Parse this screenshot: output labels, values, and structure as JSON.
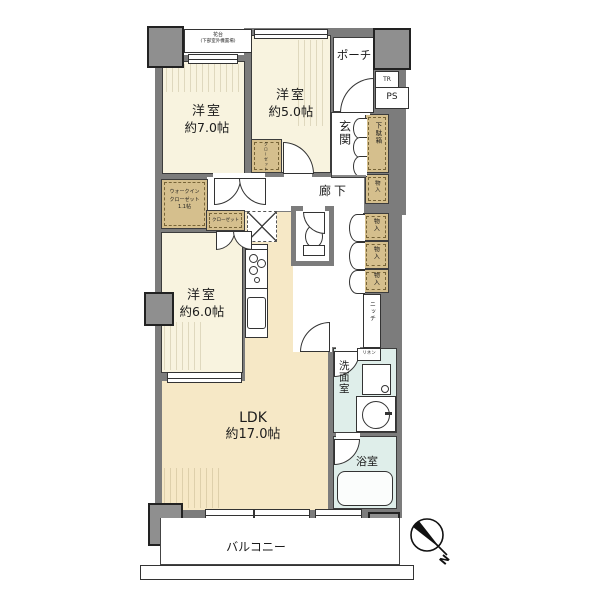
{
  "rooms": {
    "western7": {
      "name": "洋室",
      "size": "約7.0帖"
    },
    "western5": {
      "name": "洋室",
      "size": "約5.0帖"
    },
    "western6": {
      "name": "洋室",
      "size": "約6.0帖"
    },
    "ldk": {
      "name": "LDK",
      "size": "約17.0帖"
    },
    "porch": "ポーチ",
    "entrance": "玄関",
    "hallway": "廊下",
    "toilet": "トイレ",
    "washroom": "洗面室",
    "bathroom": "浴室",
    "balcony": "バルコニー",
    "niche": "ニッチ"
  },
  "storage": {
    "shoe_cabinet": "下駄箱",
    "closets": [
      "物入",
      "物入",
      "物入",
      "物入"
    ],
    "walk_in_closet": [
      "ウォークイン",
      "クローゼット",
      "1.1帖"
    ],
    "closet_5": "クローゼット",
    "closet_6": "クローゼット",
    "linen": "リネン"
  },
  "annotations": {
    "flower_stand": "花台",
    "flower_stand_note": "(下部室外機置場)",
    "trunk_room": "TR",
    "pipe_space": "PS",
    "north": "N"
  },
  "colors": {
    "wall": "#7c7c7c",
    "pillar": "#8f8f8f",
    "room_cream": "#f8f3df",
    "ldk_cream": "#f6e8c6",
    "storage_tan": "#d5bf8d",
    "wet_aqua": "#dfeeea"
  }
}
